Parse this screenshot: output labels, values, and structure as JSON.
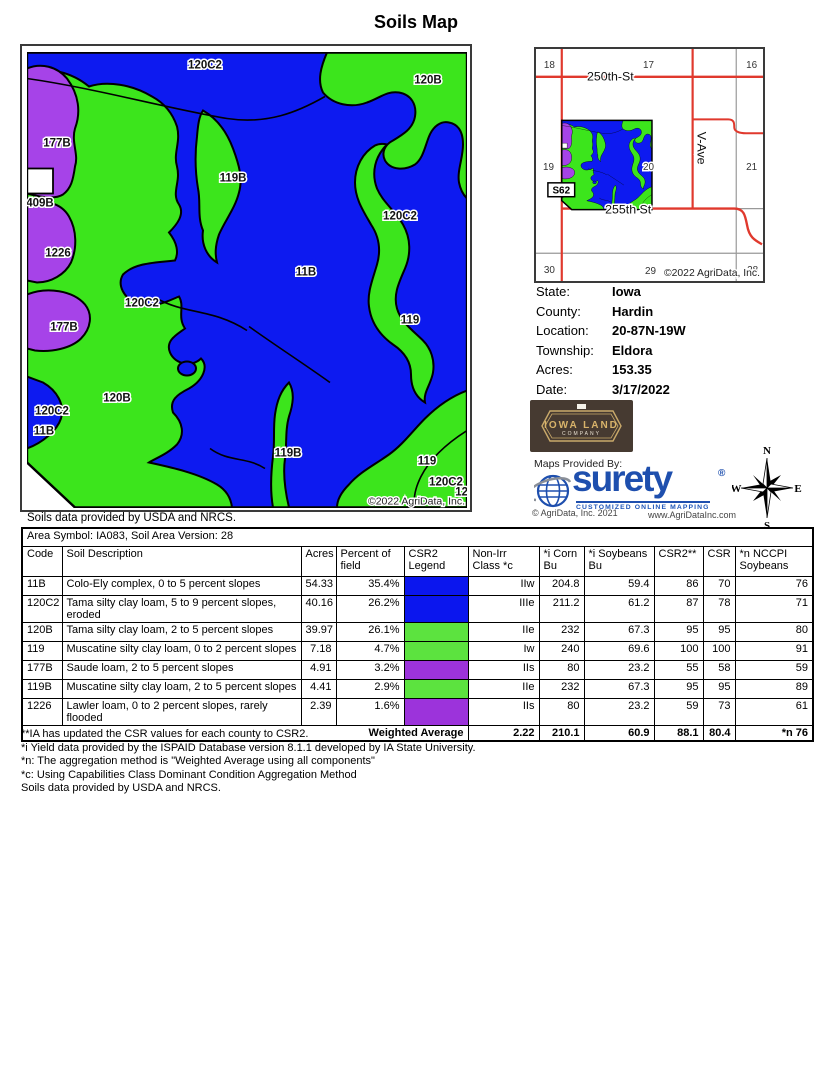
{
  "title": "Soils Map",
  "colors": {
    "map_blue": "#0d1af0",
    "map_green": "#3ce51c",
    "map_purple": "#a643e8",
    "legend_blue": "#0b16ee",
    "legend_green": "#5ce33f",
    "legend_purple": "#9c33db",
    "road_red": "#e0392d",
    "grid_gray": "#999999",
    "surety_blue": "#1e4fae"
  },
  "main_map": {
    "caption": "Soils data provided by USDA and NRCS.",
    "copyright": "©2022 AgriData, Inc.",
    "labels": [
      {
        "text": "120C2",
        "x": 178,
        "y": 16
      },
      {
        "text": "120B",
        "x": 401,
        "y": 31
      },
      {
        "text": "177B",
        "x": 30,
        "y": 94
      },
      {
        "text": "119B",
        "x": 206,
        "y": 129
      },
      {
        "text": "409B",
        "x": 13,
        "y": 154
      },
      {
        "text": "120C2",
        "x": 373,
        "y": 167
      },
      {
        "text": "1226",
        "x": 31,
        "y": 204
      },
      {
        "text": "11B",
        "x": 279,
        "y": 223
      },
      {
        "text": "120C2",
        "x": 115,
        "y": 254
      },
      {
        "text": "119",
        "x": 383,
        "y": 271
      },
      {
        "text": "177B",
        "x": 37,
        "y": 278
      },
      {
        "text": "120B",
        "x": 90,
        "y": 349
      },
      {
        "text": "120C2",
        "x": 25,
        "y": 362
      },
      {
        "text": "11B",
        "x": 17,
        "y": 382
      },
      {
        "text": "119B",
        "x": 261,
        "y": 404
      },
      {
        "text": "119",
        "x": 400,
        "y": 412
      },
      {
        "text": "120C2",
        "x": 419,
        "y": 433
      },
      {
        "text": "120B",
        "x": 442,
        "y": 443
      }
    ]
  },
  "locator_map": {
    "sections": [
      {
        "n": "18",
        "x": 8,
        "y": 19
      },
      {
        "n": "17",
        "x": 108,
        "y": 19
      },
      {
        "n": "16",
        "x": 212,
        "y": 19
      },
      {
        "n": "19",
        "x": 7,
        "y": 122
      },
      {
        "n": "20",
        "x": 108,
        "y": 122
      },
      {
        "n": "21",
        "x": 212,
        "y": 122
      },
      {
        "n": "30",
        "x": 8,
        "y": 226
      },
      {
        "n": "29",
        "x": 110,
        "y": 227
      },
      {
        "n": "28",
        "x": 213,
        "y": 226
      }
    ],
    "road_north": "250th-St",
    "road_south": "255th St",
    "road_east": "V-Ave",
    "highway": "S62",
    "copyright": "©2022 AgriData, Inc."
  },
  "info": {
    "rows": [
      {
        "label": "State:",
        "value": "Iowa"
      },
      {
        "label": "County:",
        "value": "Hardin"
      },
      {
        "label": "Location:",
        "value": "20-87N-19W"
      },
      {
        "label": "Township:",
        "value": "Eldora"
      },
      {
        "label": "Acres:",
        "value": "153.35"
      },
      {
        "label": "Date:",
        "value": "3/17/2022"
      }
    ]
  },
  "branding": {
    "company_line1": "IOWA LAND",
    "company_line2": "COMPANY",
    "maps_provided_by": "Maps Provided By:",
    "surety_name": "surety",
    "surety_reg": "®",
    "surety_tagline": "CUSTOMIZED ONLINE MAPPING",
    "surety_copyright": "© AgriData, Inc. 2021",
    "surety_website": "www.AgriDataInc.com"
  },
  "compass": {
    "n": "N",
    "e": "E",
    "s": "S",
    "w": "W"
  },
  "soil_table": {
    "area_header": "Area Symbol: IA083, Soil Area Version: 28",
    "columns": [
      "Code",
      "Soil Description",
      "Acres",
      "Percent of field",
      "CSR2 Legend",
      "Non-Irr Class *c",
      "*i Corn Bu",
      "*i Soybeans Bu",
      "CSR2**",
      "CSR",
      "*n NCCPI Soybeans"
    ],
    "rows": [
      {
        "code": "11B",
        "description": "Colo-Ely complex, 0 to 5 percent slopes",
        "acres": "54.33",
        "percent": "35.4%",
        "legend": "blue",
        "non_irr": "IIw",
        "corn": "204.8",
        "soybeans": "59.4",
        "csr2": "86",
        "csr": "70",
        "nccpi": "76"
      },
      {
        "code": "120C2",
        "description": "Tama silty clay loam, 5 to 9 percent slopes, eroded",
        "acres": "40.16",
        "percent": "26.2%",
        "legend": "blue",
        "non_irr": "IIIe",
        "corn": "211.2",
        "soybeans": "61.2",
        "csr2": "87",
        "csr": "78",
        "nccpi": "71"
      },
      {
        "code": "120B",
        "description": "Tama silty clay loam, 2 to 5 percent slopes",
        "acres": "39.97",
        "percent": "26.1%",
        "legend": "green",
        "non_irr": "IIe",
        "corn": "232",
        "soybeans": "67.3",
        "csr2": "95",
        "csr": "95",
        "nccpi": "80"
      },
      {
        "code": "119",
        "description": "Muscatine silty clay loam, 0 to 2 percent slopes",
        "acres": "7.18",
        "percent": "4.7%",
        "legend": "green",
        "non_irr": "Iw",
        "corn": "240",
        "soybeans": "69.6",
        "csr2": "100",
        "csr": "100",
        "nccpi": "91"
      },
      {
        "code": "177B",
        "description": "Saude loam, 2 to 5 percent slopes",
        "acres": "4.91",
        "percent": "3.2%",
        "legend": "purple",
        "non_irr": "IIs",
        "corn": "80",
        "soybeans": "23.2",
        "csr2": "55",
        "csr": "58",
        "nccpi": "59"
      },
      {
        "code": "119B",
        "description": "Muscatine silty clay loam, 2 to 5 percent slopes",
        "acres": "4.41",
        "percent": "2.9%",
        "legend": "green",
        "non_irr": "IIe",
        "corn": "232",
        "soybeans": "67.3",
        "csr2": "95",
        "csr": "95",
        "nccpi": "89"
      },
      {
        "code": "1226",
        "description": "Lawler loam, 0 to 2 percent slopes, rarely flooded",
        "acres": "2.39",
        "percent": "1.6%",
        "legend": "purple",
        "non_irr": "IIs",
        "corn": "80",
        "soybeans": "23.2",
        "csr2": "59",
        "csr": "73",
        "nccpi": "61"
      }
    ],
    "weighted_average": {
      "label": "Weighted Average",
      "non_irr": "2.22",
      "corn": "210.1",
      "soybeans": "60.9",
      "csr2": "88.1",
      "csr": "80.4",
      "nccpi": "*n 76"
    }
  },
  "footnotes": [
    "**IA has updated the CSR values for each county to CSR2.",
    "*i Yield data provided by the ISPAID Database version 8.1.1 developed by IA State University.",
    "*n: The aggregation method is \"Weighted Average using all components\"",
    "*c: Using Capabilities Class Dominant Condition Aggregation Method",
    "Soils data provided by USDA and NRCS."
  ]
}
